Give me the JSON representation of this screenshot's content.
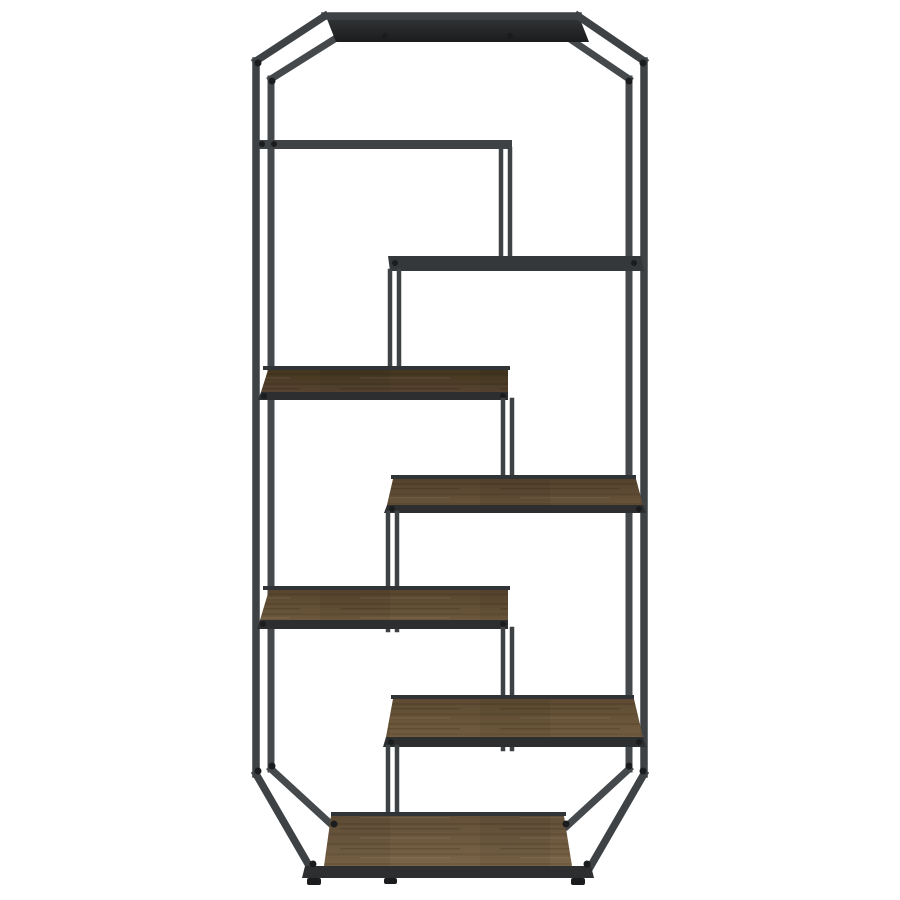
{
  "image": {
    "alt": "Six-shelf geometric etagere bookcase with dark gunmetal metal frame, chamfered corners and staggered rustic walnut wood shelves, product photo on white background"
  },
  "product": {
    "type": "bookcase",
    "style": "industrial etagere",
    "shelf_count": "6",
    "frame_finish": "dark gunmetal",
    "shelf_finish": "rustic walnut"
  },
  "colors": {
    "background": "#ffffff",
    "frame": "#3f4245",
    "frame_back": "#46494c",
    "frame_dark": "#2c2e30",
    "rail_dark": "#313436",
    "screw": "#1a1c1d",
    "top_panel_dark": "#1a1c1d",
    "top_panel_light": "#303233",
    "shelf_b_fill": "#35383a",
    "wood_c_dark": "#43361f",
    "wood_c_light": "#574430",
    "wood_d_dark": "#54422d",
    "wood_d_light": "#68533a",
    "wood_e_dark": "#57452e",
    "wood_e_light": "#6d583c",
    "wood_f_dark": "#5d4a31",
    "wood_f_light": "#735d3f",
    "wood_g_dark": "#634f38",
    "wood_g_light": "#7b6548"
  }
}
